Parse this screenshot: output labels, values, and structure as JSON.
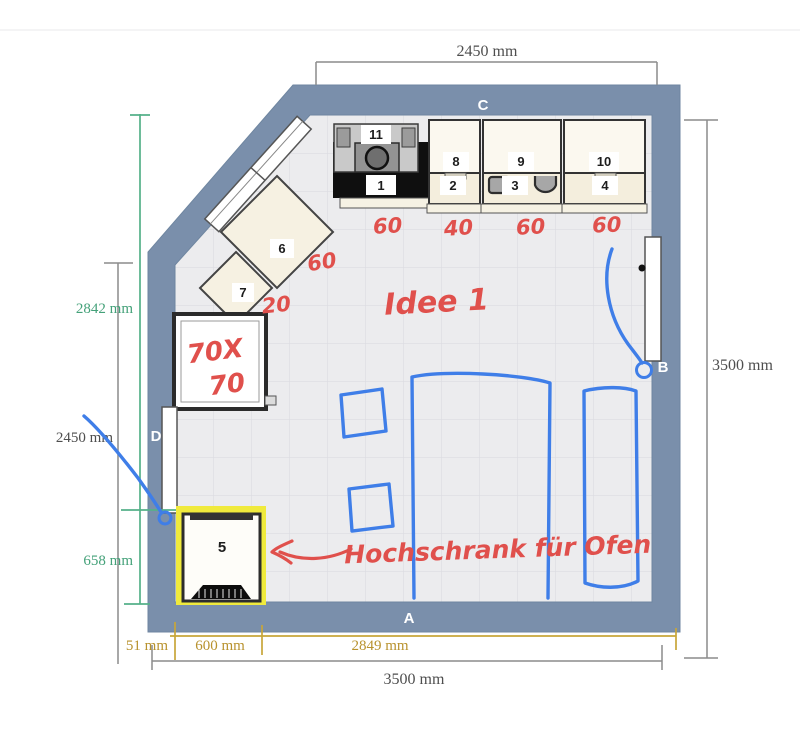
{
  "plan": {
    "walls": {
      "top": "C",
      "bottom": "A",
      "right": "B",
      "left": "D"
    },
    "dims": {
      "top": "2450 mm",
      "right": "3500 mm",
      "bottom": "3500 mm",
      "left_upper": "2842 mm",
      "left_mid": "2450 mm",
      "left_lower": "658 mm",
      "gold_left": "51 mm",
      "gold_mid": "600 mm",
      "gold_right": "2849 mm"
    },
    "items": {
      "i1": "1",
      "i2": "2",
      "i3": "3",
      "i4": "4",
      "i5": "5",
      "i6": "6",
      "i7": "7",
      "i8": "8",
      "i9": "9",
      "i10": "10",
      "i11": "11"
    },
    "notes": {
      "w1": "60",
      "w2": "40",
      "w3": "60",
      "w4": "60",
      "w6": "60",
      "w7": "20",
      "idea": "Idee 1",
      "size_line1": "70X",
      "size_line2": "70",
      "cabinet_note": "Hochschrank für Ofen"
    },
    "colors": {
      "wall": "#7a8fab",
      "floor": "#ececee",
      "annotation_red": "#e0504c",
      "annotation_blue": "#3f7ee8",
      "dim_gold": "#b8922e",
      "dim_green": "#44a179",
      "highlight_yellow": "#f0ea3c"
    }
  }
}
